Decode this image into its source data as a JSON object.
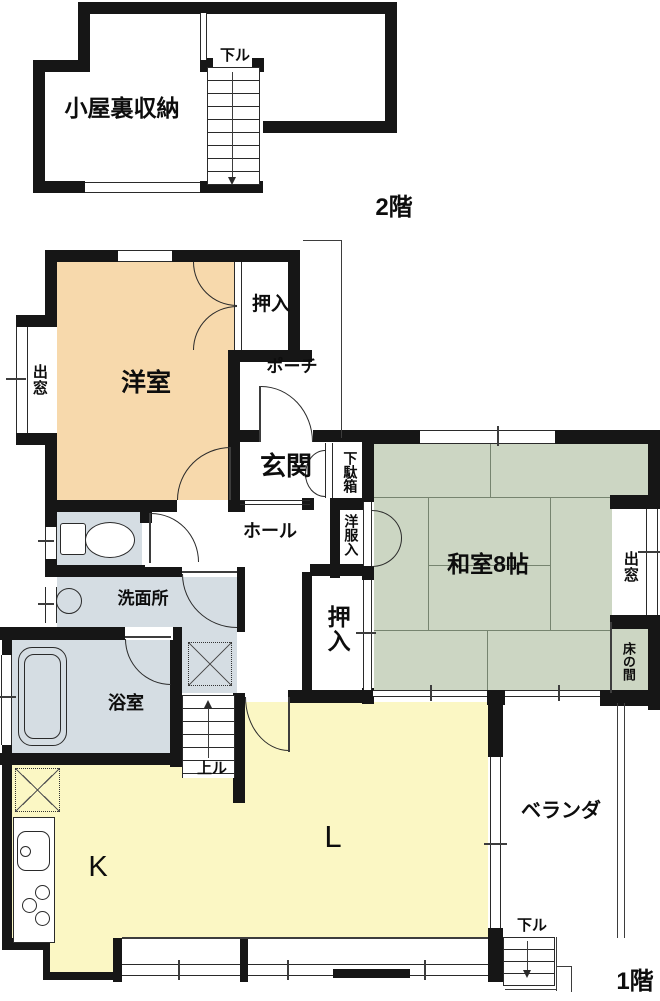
{
  "floor2": {
    "title": "2階",
    "attic_label": "小屋裏収納",
    "stairs_down_label": "下ル"
  },
  "floor1": {
    "title": "1階",
    "western_room": "洋室",
    "western_closet": "押入",
    "bay_window_west": "出窓",
    "porch": "ポーチ",
    "entrance": "玄関",
    "shoe_cabinet": "下駄箱",
    "hall": "ホール",
    "clothes_closet": "洋服入",
    "japanese_room": "和室8帖",
    "bay_window_east": "出窓",
    "hall_closet": "押入",
    "tokonoma": "床の間",
    "washroom": "洗面所",
    "bathroom": "浴室",
    "stairs_up_label": "上ル",
    "kitchen": "K",
    "living": "L",
    "veranda": "ベランダ",
    "veranda_steps_label": "下ル"
  },
  "colors": {
    "western_room": "#f7d9ac",
    "japanese_room": "#ccd6c3",
    "ldk": "#fbf7c4",
    "wet_area": "#d5dde3",
    "wall": "#161616"
  }
}
